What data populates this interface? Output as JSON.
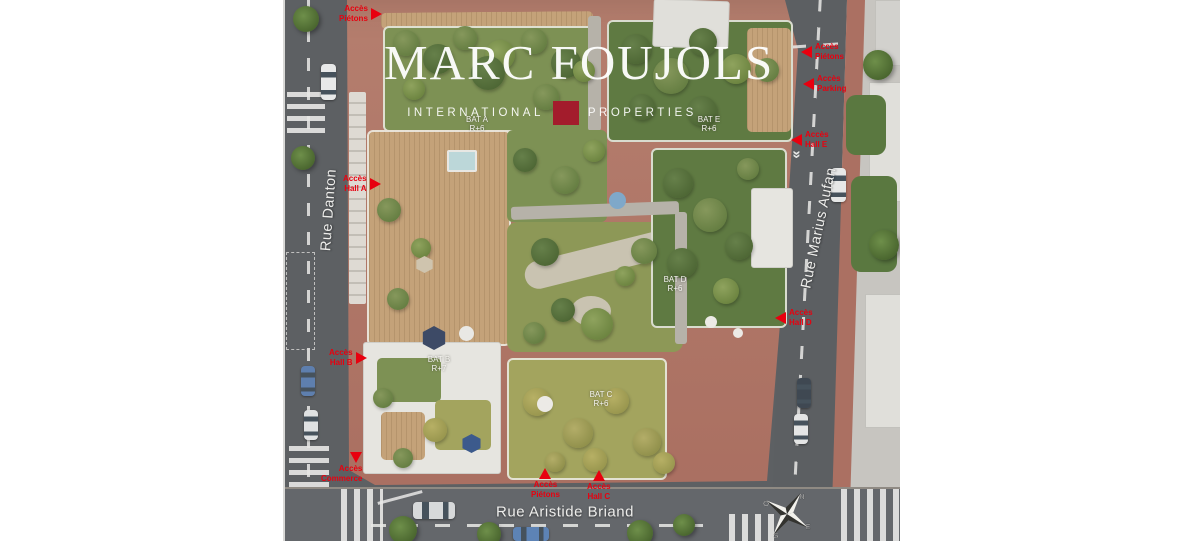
{
  "watermark": {
    "title": "MARC FOUJOLS",
    "subtitle_left": "INTERNATIONAL",
    "subtitle_right": "PROPERTIES"
  },
  "streets": {
    "left": "Rue Danton",
    "right": "Rue Marius Aufan",
    "bottom": "Rue Aristide Briand"
  },
  "access_points": [
    {
      "id": "pietons-top-left",
      "line1": "Accès",
      "line2": "Piétons",
      "arrow": "right"
    },
    {
      "id": "hall-a",
      "line1": "Accès",
      "line2": "Hall A",
      "arrow": "right"
    },
    {
      "id": "hall-b",
      "line1": "Accès",
      "line2": "Hall B",
      "arrow": "right"
    },
    {
      "id": "commerce",
      "line1": "Accès",
      "line2": "Commerce",
      "arrow": "down"
    },
    {
      "id": "pietons-bottom",
      "line1": "Accès",
      "line2": "Piétons",
      "arrow": "up"
    },
    {
      "id": "hall-c",
      "line1": "Accès",
      "line2": "Hall C",
      "arrow": "up"
    },
    {
      "id": "hall-d",
      "line1": "Accès",
      "line2": "Hall D",
      "arrow": "left"
    },
    {
      "id": "pietons-right",
      "line1": "Accès",
      "line2": "Piétons",
      "arrow": "left"
    },
    {
      "id": "parking",
      "line1": "Accès",
      "line2": "Parking",
      "arrow": "left"
    },
    {
      "id": "hall-e",
      "line1": "Accès",
      "line2": "Hall E",
      "arrow": "left"
    }
  ],
  "buildings": [
    {
      "name": "BAT A",
      "floors": "R+6"
    },
    {
      "name": "BAT B",
      "floors": "R+7"
    },
    {
      "name": "BAT C",
      "floors": "R+6"
    },
    {
      "name": "BAT D",
      "floors": "R+6"
    },
    {
      "name": "BAT E",
      "floors": "R+6"
    }
  ],
  "compass": {
    "north": "N",
    "east": "E",
    "south": "S",
    "west": "O"
  },
  "colors": {
    "access_red": "#E8000F",
    "logo_red": "#A31C2C"
  }
}
